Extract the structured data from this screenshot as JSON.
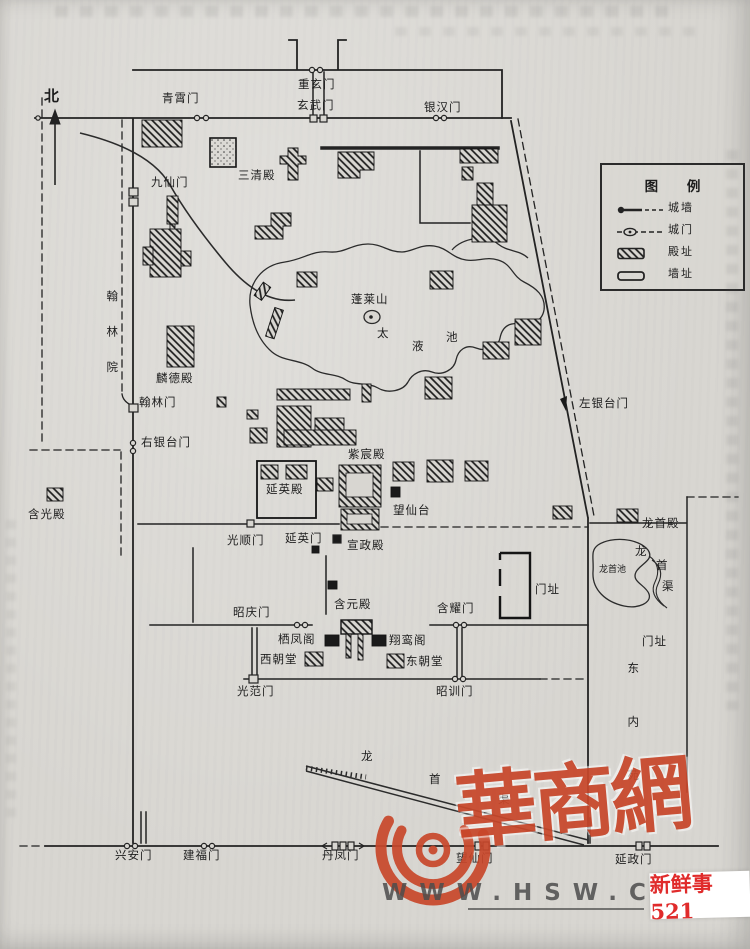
{
  "colors": {
    "paper": "#d8d6d1",
    "ink": "#1f1f1f",
    "watermark_red": "#c8472b",
    "badge_red": "#e02b2b",
    "url_gray": "#4d4d4d"
  },
  "compass": {
    "north": "北"
  },
  "legend": {
    "title": "图 例",
    "items": [
      {
        "symbol": "city-wall-line",
        "label": "城墙"
      },
      {
        "symbol": "city-gate-mark",
        "label": "城门"
      },
      {
        "symbol": "hall-site-hatch",
        "label": "殿址"
      },
      {
        "symbol": "wall-site-outline",
        "label": "墙址"
      }
    ]
  },
  "labels": {
    "qingxiaomen": "青霄门",
    "chongxuanmen": "重玄门",
    "xuanwumen": "玄武门",
    "yinhanmen": "银汉门",
    "jiuxianmen": "九仙门",
    "sanqingdian": "三清殿",
    "hanlinyuan": "翰林院",
    "lindedian": "麟德殿",
    "hanlinmen": "翰林门",
    "youyintaimen": "右银台门",
    "hanguangdian": "含光殿",
    "penglaishan": "蓬莱山",
    "tai": "太",
    "ye": "液",
    "chi": "池",
    "zuoyintaimen": "左银台门",
    "zichendian": "紫宸殿",
    "yanyingdian": "延英殿",
    "wangxiantai": "望仙台",
    "guangshunmen": "光顺门",
    "yanyingmen": "延英门",
    "xuanzhengdian": "宣政殿",
    "longshoudian": "龙首殿",
    "longshouchi": "龙首池",
    "qu_long": "龙",
    "qu_shou": "首",
    "qu_qu": "渠",
    "menzhi_east": "门址",
    "hanyaomen": "含耀门",
    "zhaoqingmen": "昭庆门",
    "hanyuandian": "含元殿",
    "menzhi_south": "门址",
    "qifengge": "栖凤阁",
    "xiangluange": "翔鸾阁",
    "xichaotang": "西朝堂",
    "dongchaotang": "东朝堂",
    "guangfanmen": "光范门",
    "zhaoxunmen": "昭训门",
    "dongneiyuan": "东内苑",
    "canal_long": "龙",
    "canal_shou": "首",
    "canal_qu": "渠",
    "xinganmen": "兴安门",
    "jianfumen": "建福门",
    "danfengmen": "丹凤门",
    "wangxianmen": "望仙门",
    "yanzhengmen": "延政门"
  },
  "watermark": {
    "brand": "華商網",
    "url": "WWW.HSW.CN",
    "badge": "新鲜事521"
  }
}
